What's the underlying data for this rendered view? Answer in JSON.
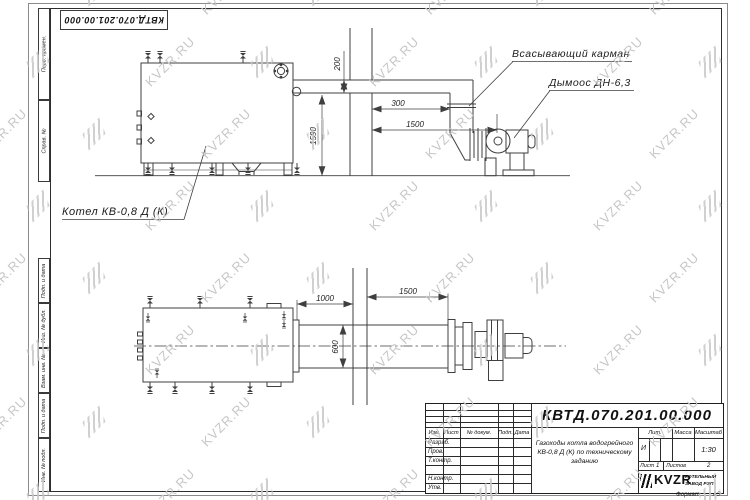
{
  "page": {
    "background": "#ffffff",
    "line_color": "#3f3f3f",
    "top_stamp": "КВТД.070.201.00.000",
    "watermark": {
      "text": "KVZR.RU",
      "color": "#c7c7c7"
    },
    "format_note": {
      "label": "Формат",
      "value": "А3"
    }
  },
  "frame": {
    "side_labels": [
      "Перв. примен.",
      "Справ. №",
      "Подп. и дата",
      "Инв. № дубл.",
      "Взам. инв. №",
      "Подп. и дата",
      "Инв. № подл."
    ]
  },
  "views": {
    "upper": {
      "boiler_label": "Котел КВ-0,8 Д (К)",
      "suction_label": "Всасывающий карман",
      "exhauster_label": "Дымоос ДН-6,3",
      "dims": {
        "duct_height": "200",
        "wall_offset": "300",
        "wall_to_fan": "1500",
        "duct_axis_height": "1590"
      }
    },
    "lower": {
      "dims": {
        "flange_to_wall": "1000",
        "wall_to_duct_end": "1500",
        "duct_width": "600"
      }
    }
  },
  "title_block": {
    "designation": "КВТД.070.201.00.000",
    "description_lines": [
      "Газоходы котла водогрейного",
      "КВ-0,8 Д (К) по техническому",
      "заданию"
    ],
    "header_cols": [
      "Изм.",
      "Лист",
      "№ докум.",
      "Подп.",
      "Дата"
    ],
    "row_labels": [
      "Разраб.",
      "Пров.",
      "Т.контр.",
      "Н.контр.",
      "Утв."
    ],
    "lit_header": "Лит.",
    "mass_header": "Масса",
    "scale_header": "Масштаб",
    "lit_value": "И",
    "scale_value": "1:30",
    "sheet_label": "Лист",
    "sheet_value": "1",
    "sheets_label": "Листов",
    "sheets_value": "2",
    "logo_text": "KVZR",
    "company_lines": [
      "КОТЕЛЬНЫЙ",
      "ЗАВОД РЭП"
    ]
  }
}
